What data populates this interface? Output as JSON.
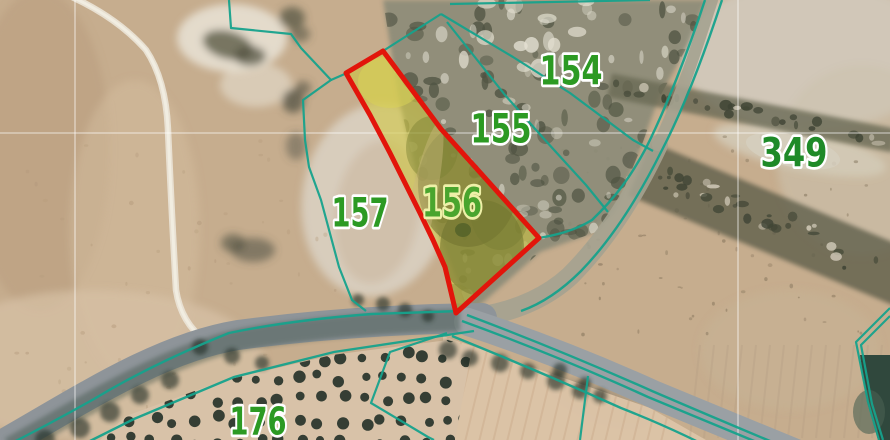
{
  "app": {
    "type": "cadastral-aerial-map-view"
  },
  "colors": {
    "base_tan": "#c6ad8e",
    "boundary_teal": "#16a28c",
    "highlight_red": "#e2150b",
    "highlight_yellow": "#cfc63e",
    "label_green": "#2c9a23",
    "label_green_on_yellow": "#4aa52e",
    "label_halo": "#ffffff",
    "label_halo_on_yellow": "#eef0a8",
    "grid_white": "rgba(255,255,255,0.55)",
    "road_grey": "#8e9499",
    "road_tan": "#a4a290",
    "scrub": "#8b8b78",
    "grove_ground": "#d8c2a8",
    "tree_dark": "#222e26",
    "dark_corner": "#30483d"
  },
  "labels": [
    {
      "text": "154",
      "x": 571,
      "y": 70,
      "fs": 40,
      "tl": 63,
      "fill": "#2c9a23",
      "halo": "#ffffff"
    },
    {
      "text": "155",
      "x": 501,
      "y": 128,
      "fs": 40,
      "tl": 61,
      "fill": "#2c9a23",
      "halo": "#ffffff"
    },
    {
      "text": "156",
      "x": 452,
      "y": 202,
      "fs": 40,
      "tl": 60,
      "fill": "#4aa52e",
      "halo": "#eef0a8"
    },
    {
      "text": "157",
      "x": 360,
      "y": 212,
      "fs": 40,
      "tl": 57,
      "fill": "#2c9a23",
      "halo": "#ffffff"
    },
    {
      "text": "349",
      "x": 794,
      "y": 152,
      "fs": 40,
      "tl": 67,
      "fill": "#1f8a28",
      "halo": "#ffffff"
    },
    {
      "text": "176",
      "x": 258,
      "y": 421,
      "fs": 38,
      "tl": 57,
      "fill": "#2c9a23",
      "halo": "#ffffff"
    }
  ],
  "highlight_parcel": {
    "label": "156",
    "fill": "#cfc63e",
    "fill_opacity": 0.58,
    "stroke": "#e2150b",
    "stroke_width": 5,
    "points": [
      [
        346,
        73
      ],
      [
        383,
        51
      ],
      [
        441,
        129
      ],
      [
        539,
        238
      ],
      [
        456,
        313
      ],
      [
        445,
        267
      ],
      [
        433,
        240
      ],
      [
        420,
        213
      ],
      [
        405,
        183
      ],
      [
        390,
        153
      ],
      [
        370,
        115
      ]
    ],
    "inner_blobs": [
      [
        468,
        185,
        50,
        62,
        0,
        "#6f7030",
        0.55
      ],
      [
        432,
        148,
        26,
        32,
        0,
        "#7a8034",
        0.45
      ],
      [
        482,
        248,
        42,
        48,
        0,
        "#6e732d",
        0.55
      ],
      [
        500,
        210,
        30,
        40,
        0,
        "#767b31",
        0.4
      ],
      [
        476,
        160,
        7,
        6,
        0,
        "#465522",
        0.8
      ],
      [
        493,
        179,
        6,
        5,
        0,
        "#465522",
        0.8
      ],
      [
        463,
        230,
        8,
        7,
        0,
        "#4d5c26",
        0.7
      ],
      [
        390,
        82,
        32,
        26,
        0,
        "#d8d157",
        0.55
      ],
      [
        420,
        215,
        13,
        95,
        12,
        "#c9b77d",
        0.45
      ],
      [
        455,
        300,
        18,
        16,
        0,
        "#8a8c3a",
        0.5
      ]
    ]
  },
  "boundaries": [
    "M229,0 L231,28 L291,34 L301,48 L331,80 L303,100 L305,140 L309,167 L321,200 L339,267 L352,300 L366,311",
    "M331,80 L347,73",
    "M450,4 L600,1 L650,0",
    "M441,14 L513,57 L570,93 L633,140 L653,151",
    "M447,22 L505,95 L545,140 L586,185 L608,212",
    "M383,51 L441,14",
    "M447,333 L390,352 L371,403 L428,437 L434,440",
    "M588,376 L580,440",
    "M890,308 L856,342 L868,402 L879,440",
    "M890,316 L861,345 L872,404 L883,440"
  ],
  "road_edges": [
    "M705,0 C688,52 666,108 646,148 C631,176 616,197 592,220 C574,231 556,235 539,238",
    "M722,0 C705,52 683,110 661,152 C639,196 613,238 581,271 C561,291 541,304 521,311",
    "M461,311 L372,314 Q292,320 229,333 Q152,364 94,399 Q46,426 0,449",
    "M474,331 L334,352 L234,377 L134,419 L68,452",
    "M467,315 Q560,350 652,391 Q731,425 806,456",
    "M462,321 Q558,356 648,397 Q727,430 800,460",
    "M452,336 Q541,372 621,408 Q682,432 731,459"
  ],
  "road_surfaces": [
    {
      "d": "M712,0 C696,50 680,100 658,145",
      "w": 12,
      "c": "#a4a290",
      "op": 0.9
    },
    {
      "d": "M658,145 C636,192 608,238 570,276 C546,298 517,310 484,316",
      "w": 20,
      "c": "#a4a290",
      "op": 0.9
    },
    {
      "d": "M482,318 C400,319 320,324 238,335 C158,348 78,402 0,446",
      "w": 30,
      "c": "#8e9499",
      "op": 1
    },
    {
      "d": "M468,322 Q560,352 655,395 Q740,430 808,458",
      "w": 28,
      "c": "#9aa0a4",
      "op": 1
    }
  ],
  "road_shade": {
    "d": "M460,320 C390,322 320,327 250,338 C170,352 90,404 10,448",
    "w": 22,
    "c": "#3c5146",
    "op": 0.42
  },
  "grid": {
    "v": [
      75,
      738
    ],
    "h": [
      133
    ],
    "w": 1.3
  },
  "regions": {
    "scrub_poly": [
      [
        383,
        0
      ],
      [
        706,
        0
      ],
      [
        688,
        45
      ],
      [
        658,
        100
      ],
      [
        640,
        150
      ],
      [
        615,
        210
      ],
      [
        596,
        232
      ],
      [
        540,
        252
      ],
      [
        470,
        314
      ],
      [
        445,
        250
      ],
      [
        420,
        190
      ],
      [
        398,
        95
      ]
    ],
    "scrub_fill": "#8b8b78",
    "grove_poly": [
      [
        100,
        440
      ],
      [
        126,
        416
      ],
      [
        222,
        381
      ],
      [
        332,
        355
      ],
      [
        448,
        340
      ],
      [
        472,
        348
      ],
      [
        455,
        440
      ]
    ],
    "grove_fill": "#d8c2a8",
    "furrow_poly": [
      [
        443,
        336
      ],
      [
        650,
        408
      ],
      [
        706,
        440
      ],
      [
        446,
        440
      ]
    ],
    "furrow_fill": "#dcc4a8",
    "dark_corner_poly": [
      [
        860,
        355
      ],
      [
        890,
        355
      ],
      [
        890,
        440
      ],
      [
        878,
        440
      ],
      [
        867,
        402
      ]
    ],
    "blobs": [
      [
        40,
        150,
        70,
        160,
        0,
        "#b89c7c",
        0.5
      ],
      [
        135,
        230,
        65,
        150,
        0,
        "#d3bb9c",
        0.55
      ],
      [
        95,
        365,
        170,
        75,
        0,
        "#d7c2a6",
        0.7
      ],
      [
        810,
        55,
        130,
        75,
        0,
        "#d2cabc",
        0.9
      ],
      [
        862,
        160,
        85,
        95,
        0,
        "#ccc2ae",
        0.6
      ],
      [
        800,
        150,
        88,
        20,
        12,
        "#d4cbb8",
        0.85
      ],
      [
        232,
        38,
        55,
        34,
        0,
        "#e9e3d6",
        0.85
      ],
      [
        256,
        85,
        36,
        22,
        0,
        "#e6dfd0",
        0.6
      ],
      [
        376,
        200,
        74,
        97,
        8,
        "#d9cfc0",
        0.92
      ],
      [
        377,
        212,
        42,
        72,
        8,
        "#cbb79d",
        0.55
      ],
      [
        228,
        45,
        26,
        14,
        15,
        "#5c5c48",
        0.8
      ],
      [
        250,
        56,
        16,
        10,
        0,
        "#4e4f3d",
        0.7
      ],
      [
        292,
        18,
        13,
        11,
        0,
        "#565743",
        0.75
      ],
      [
        300,
        34,
        10,
        8,
        0,
        "#565743",
        0.6
      ],
      [
        293,
        101,
        11,
        12,
        0,
        "#525244",
        0.75
      ],
      [
        303,
        88,
        8,
        7,
        0,
        "#525244",
        0.6
      ],
      [
        253,
        250,
        22,
        12,
        0,
        "#55564a",
        0.6
      ],
      [
        233,
        243,
        12,
        9,
        0,
        "#4d4e40",
        0.6
      ],
      [
        296,
        146,
        10,
        14,
        0,
        "#55564a",
        0.5
      ],
      [
        600,
        404,
        52,
        18,
        20,
        "#8a7f6d",
        0.5
      ],
      [
        790,
        350,
        90,
        60,
        0,
        "#c8b396",
        0.5
      ]
    ],
    "stripes": [
      {
        "cx": 752,
        "cy": 113,
        "w": 290,
        "h": 24,
        "rot": 11,
        "fill": "#6b6a55",
        "op": 0.8
      },
      {
        "cx": 778,
        "cy": 226,
        "w": 300,
        "h": 58,
        "rot": 22.5,
        "fill": "#5e5f4b",
        "op": 0.8
      }
    ],
    "stripe_lines": [
      {
        "from": [
          612,
          86
        ],
        "to": [
          890,
          140
        ],
        "spread": 12,
        "seed": 21,
        "n": 26
      },
      {
        "from": [
          639,
          169
        ],
        "to": [
          890,
          272
        ],
        "spread": 26,
        "seed": 22,
        "n": 34
      }
    ],
    "track": {
      "d": "M70,-4 Q118,18 146,50 Q166,80 168,130 Q172,220 176,290 Q181,323 206,341",
      "c": "#eae4d7",
      "w": 6.5,
      "core": "#f2ede2"
    },
    "road_trees": [
      [
        448,
        350,
        9
      ],
      [
        470,
        358,
        8
      ],
      [
        500,
        363,
        9
      ],
      [
        528,
        371,
        8
      ],
      [
        556,
        381,
        9
      ],
      [
        580,
        391,
        8
      ],
      [
        600,
        396,
        7
      ],
      [
        383,
        304,
        7
      ],
      [
        358,
        300,
        6
      ],
      [
        405,
        310,
        7
      ],
      [
        428,
        316,
        6
      ],
      [
        200,
        347,
        8
      ],
      [
        232,
        356,
        8
      ],
      [
        262,
        363,
        7
      ],
      [
        170,
        380,
        9
      ],
      [
        140,
        395,
        9
      ],
      [
        110,
        412,
        10
      ],
      [
        80,
        428,
        10
      ],
      [
        45,
        440,
        10
      ],
      [
        560,
        370,
        7
      ],
      [
        585,
        383,
        6
      ]
    ],
    "dark_corner_blob": [
      869,
      412,
      16,
      22,
      0,
      "#4a6152",
      0.6
    ]
  },
  "textures": {
    "scrub_dark": {
      "seed": 7,
      "n": 110,
      "bbox": [
        385,
        0,
        700,
        318
      ],
      "rmin": 3,
      "rmax": 9,
      "fill": "#4f5342",
      "opmin": 0.45,
      "opmax": 0.8
    },
    "scrub_light": {
      "seed": 8,
      "n": 60,
      "bbox": [
        390,
        0,
        690,
        300
      ],
      "rmin": 2,
      "rmax": 7,
      "fill": "#d9d6c8",
      "opmin": 0.4,
      "opmax": 0.7
    },
    "scrub_rocks": {
      "seed": 9,
      "n": 14,
      "bbox": [
        430,
        0,
        600,
        70
      ],
      "rmin": 4,
      "rmax": 10,
      "fill": "#e4e0d2",
      "opmin": 0.5,
      "opmax": 0.8
    },
    "right_speck": {
      "seed": 11,
      "n": 70,
      "bbox": [
        555,
        135,
        885,
        335
      ],
      "rmin": 0.8,
      "rmax": 2.4,
      "fill": "#7e6e56",
      "opmin": 0.3,
      "opmax": 0.55
    },
    "left_speck": {
      "seed": 5,
      "n": 55,
      "bbox": [
        0,
        140,
        340,
        430
      ],
      "rmin": 1,
      "rmax": 2.6,
      "fill": "#b49a7c",
      "opmin": 0.3,
      "opmax": 0.5
    },
    "grove_dots": {
      "seed": 3,
      "step": 21,
      "jit": 5,
      "rmin": 4,
      "rmax": 6.2,
      "fill": "#27332a",
      "op": 0.92
    },
    "furrow_step": 14,
    "furrow_color": "#c7a98a",
    "right_streaks": {
      "x0": 700,
      "x1": 888,
      "y0": 345,
      "y1": 438,
      "step": 14,
      "color": "#b49e83",
      "op": 0.35
    }
  }
}
